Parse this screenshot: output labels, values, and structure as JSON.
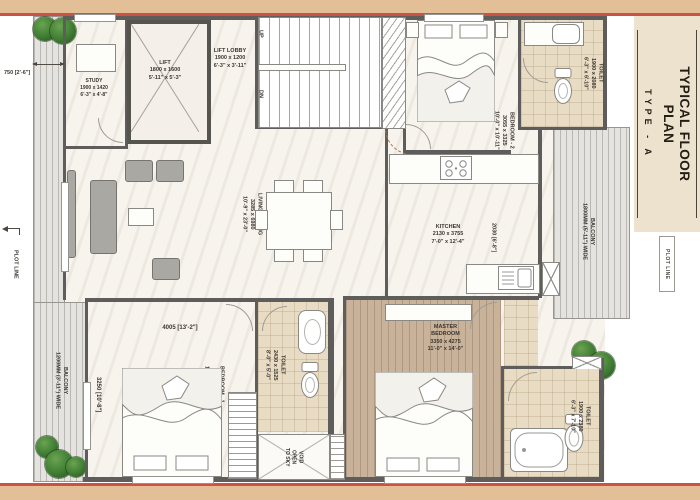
{
  "title_block": {
    "title_line1": "TYPICAL FLOOR",
    "title_line2": "PLAN",
    "type_label": "TYPE - A",
    "plot_line": "PLOT LINE"
  },
  "annotations": {
    "plot_line_left": "PLOT LINE",
    "dim_left_balcony": "750 [2'-6\"]",
    "dim_bedroom1_width": "4005 [13'-2\"]",
    "dim_bedroom1_height": "3250 [10'-8\"]",
    "dim_kitchen": "2030 [6'-8\"]",
    "stairs_up": "UP",
    "stairs_dn": "DN"
  },
  "rooms": {
    "study": {
      "name": "STUDY",
      "mm": "1900 x 1420",
      "ft": "6'-3\" x 4'-8\""
    },
    "lift": {
      "name": "LIFT",
      "mm": "1800 x 1600",
      "ft": "5'-11\" x 5'-3\""
    },
    "lift_lobby": {
      "name": "LIFT LOBBY",
      "mm": "1900 x 1200",
      "ft": "6'-3\" x 3'-11\""
    },
    "bedroom2": {
      "name": "BEDROOM - 2",
      "mm": "3055 x 3325",
      "ft": "10'-0\" x 10'-11\""
    },
    "toilet_bed2": {
      "name": "TOILET",
      "mm": "1900 x 2080",
      "ft": "6'-3\" x 6'-10\""
    },
    "living_dining": {
      "name": "LIVING / DINING",
      "mm": "3285 x 6980",
      "ft": "10'-9\" x 23'-0\""
    },
    "kitchen": {
      "name": "KITCHEN",
      "mm": "2130 x 3755",
      "ft": "7'-0\" x 12'-4\""
    },
    "bedroom1": {
      "name": "BEDROOM - 1",
      "mm": "3350 x 4105",
      "ft": "11'-0\" x 13'-6\""
    },
    "toilet_common": {
      "name": "TOILET",
      "mm": "2430 x 1525",
      "ft": "8'-0\" x 5'-0\""
    },
    "master_bedroom": {
      "name1": "MASTER",
      "name2": "BEDROOM",
      "mm": "3350 x 4275",
      "ft": "11'-0\" x 14'-0\""
    },
    "toilet_master": {
      "name": "TOILET",
      "mm": "1900 x 2380",
      "ft": "6'-3\" x 7'-10\""
    },
    "void": {
      "l1": "VOID",
      "l2": "OPEN",
      "l3": "TO SKY"
    }
  },
  "balconies": {
    "left": {
      "name": "BALCONY",
      "size": "1200MM (3'-11\") WIDE"
    },
    "right": {
      "name": "BALCONY",
      "size": "1800MM (5'-11\") WIDE"
    }
  },
  "colors": {
    "border_band": "#e2bf97",
    "border_red": "#cb5244",
    "sidebar_beige": "#ece2cd",
    "wall_gray": "#5e5d5b",
    "wood_floor": "#c9b29a",
    "tile_floor": "#e9dcc5",
    "tree_green": "#3f7d33"
  }
}
